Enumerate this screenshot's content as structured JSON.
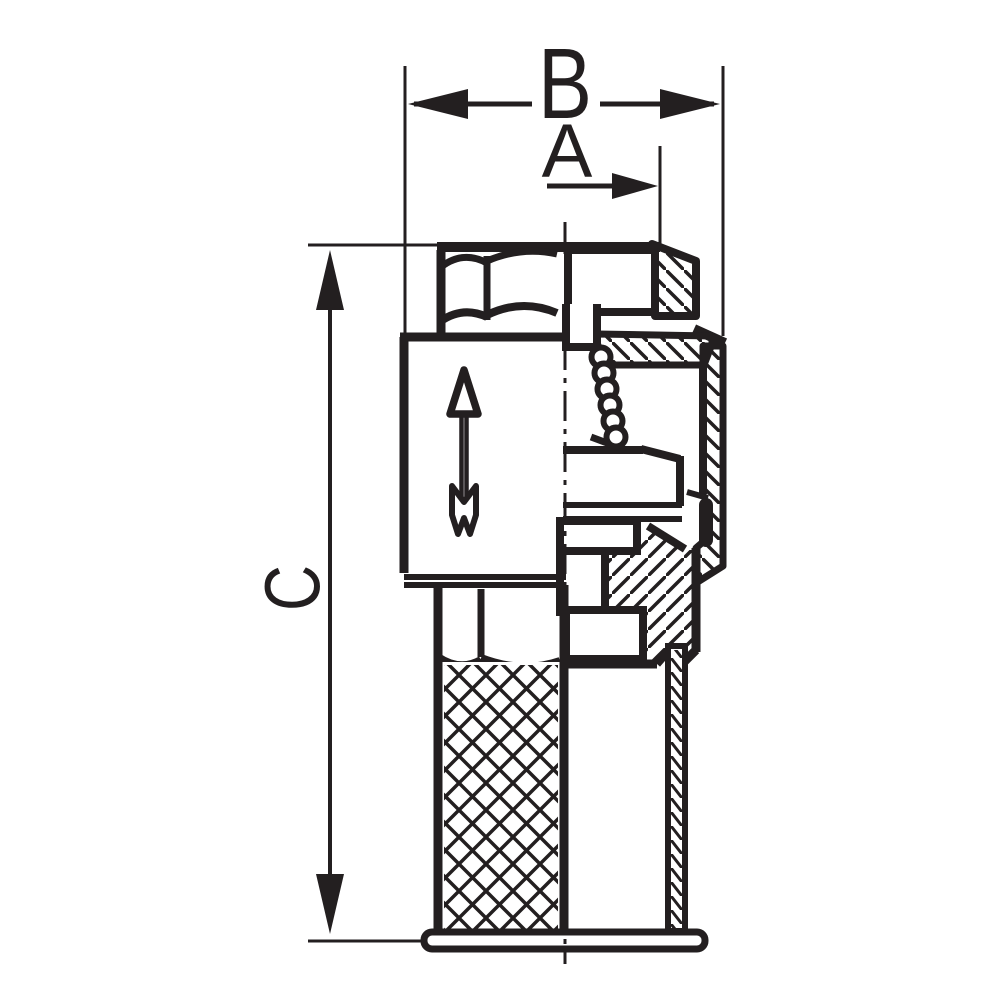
{
  "page": {
    "background": "#ffffff",
    "ink_color": "#231f20"
  },
  "drawing": {
    "kind": "technical-section-drawing",
    "labels": {
      "width_dim": "B",
      "inlet_dim": "A",
      "height_dim": "C"
    }
  }
}
